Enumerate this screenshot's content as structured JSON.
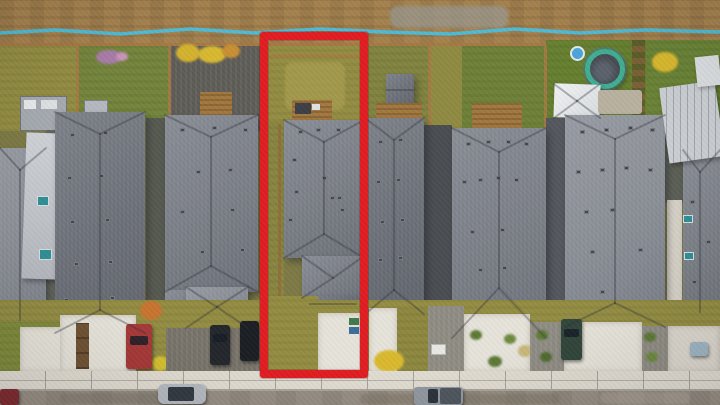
{
  "image": {
    "type": "aerial-drone-photo",
    "subject": "Top-down aerial photo of a row of narrow-lot single-family homes; one property is outlined with a red rectangle (real-estate listing highlight)",
    "width": 720,
    "height": 405,
    "visible_text": ""
  },
  "colors": {
    "highlight-red": "#e01d22",
    "dirt": "#a5824f",
    "pipe-blue": "#49bedd",
    "fence-wood": "#a97843",
    "grass-olive": "#938d43",
    "grass-olive-light": "#a89c4e",
    "grass-green": "#74853c",
    "grass-vivid": "#66802f",
    "gravel-dark": "#5d5b55",
    "gravel-light": "#8d8a82",
    "roof-main": "#797d85",
    "roof-dark": "#6b6f77",
    "roof-light": "#888c94",
    "roof-pale": "#9fa4ab",
    "roof-white": "#ccd0d4",
    "concrete": "#e6e3da",
    "sidewalk": "#e0dcd2",
    "street": "#968e84",
    "street-dark": "#7e776e",
    "deck-wood": "#a3783f",
    "stone-path": "#b3ac9c",
    "shadow-gap": "#54575d",
    "trampoline-ring": "#3fae92",
    "trampoline-mat": "#474b52",
    "pool-blue": "#4da4d8",
    "car-red": "#a63838",
    "car-darkred": "#7e2b30",
    "car-silver": "#b4bac0",
    "car-black": "#23262b",
    "car-green-suv": "#31463a",
    "truck-gray": "#9198a0",
    "skylight-teal": "#2e8f96"
  },
  "highlight": {
    "x": 260,
    "y": 32,
    "width": 108,
    "height": 346,
    "border_px": 8,
    "purpose": "outlined property for sale"
  },
  "scene": {
    "objects": [
      "dirt-alley",
      "water-supply-line",
      "back-fence",
      "backyards",
      "utility-trailer",
      "trampoline",
      "kiddie-pool",
      "gazebo-roof",
      "garden-shed",
      "wood-decks",
      "stone-path",
      "house-roofs",
      "roof-vents",
      "front-driveways",
      "xeriscape-beds",
      "parked-cars",
      "sidewalk",
      "street",
      "property-highlight-outline"
    ],
    "water_line_points": "0,33 55,30 120,34 190,29 255,33 320,29 385,32 450,34 515,29 580,33 645,30 720,32",
    "roof_vents": [
      [
        70,
        133
      ],
      [
        103,
        131
      ],
      [
        67,
        176
      ],
      [
        99,
        174
      ],
      [
        70,
        220
      ],
      [
        105,
        218
      ],
      [
        74,
        262
      ],
      [
        108,
        260
      ],
      [
        64,
        298
      ],
      [
        110,
        296
      ],
      [
        180,
        128
      ],
      [
        212,
        126
      ],
      [
        243,
        128
      ],
      [
        196,
        170
      ],
      [
        228,
        168
      ],
      [
        180,
        210
      ],
      [
        230,
        208
      ],
      [
        200,
        250
      ],
      [
        240,
        248
      ],
      [
        298,
        130
      ],
      [
        316,
        128
      ],
      [
        336,
        128
      ],
      [
        292,
        158
      ],
      [
        294,
        190
      ],
      [
        288,
        218
      ],
      [
        322,
        176
      ],
      [
        330,
        196
      ],
      [
        337,
        196
      ],
      [
        340,
        208
      ],
      [
        378,
        140
      ],
      [
        398,
        138
      ],
      [
        376,
        180
      ],
      [
        396,
        178
      ],
      [
        380,
        220
      ],
      [
        400,
        218
      ],
      [
        378,
        258
      ],
      [
        398,
        256
      ],
      [
        466,
        142
      ],
      [
        486,
        140
      ],
      [
        506,
        140
      ],
      [
        524,
        142
      ],
      [
        462,
        180
      ],
      [
        478,
        178
      ],
      [
        496,
        176
      ],
      [
        514,
        178
      ],
      [
        470,
        230
      ],
      [
        500,
        228
      ],
      [
        478,
        268
      ],
      [
        502,
        266
      ],
      [
        580,
        130
      ],
      [
        604,
        128
      ],
      [
        628,
        126
      ],
      [
        650,
        128
      ],
      [
        576,
        170
      ],
      [
        600,
        168
      ],
      [
        624,
        166
      ],
      [
        648,
        168
      ],
      [
        584,
        210
      ],
      [
        610,
        208
      ],
      [
        590,
        250
      ],
      [
        638,
        248
      ],
      [
        600,
        290
      ],
      [
        690,
        200
      ],
      [
        706,
        240
      ],
      [
        692,
        280
      ]
    ],
    "ridge_lines": [
      [
        100,
        134,
        100,
        310
      ],
      [
        55,
        112,
        100,
        134
      ],
      [
        145,
        112,
        100,
        134
      ],
      [
        55,
        333,
        100,
        310
      ],
      [
        145,
        333,
        100,
        310
      ],
      [
        211,
        137,
        211,
        266
      ],
      [
        165,
        115,
        211,
        137
      ],
      [
        258,
        115,
        211,
        137
      ],
      [
        165,
        292,
        211,
        266
      ],
      [
        258,
        292,
        211,
        266
      ],
      [
        186,
        287,
        217,
        307
      ],
      [
        248,
        287,
        217,
        307
      ],
      [
        186,
        328,
        217,
        307
      ],
      [
        248,
        328,
        217,
        307
      ],
      [
        324,
        142,
        324,
        234
      ],
      [
        284,
        120,
        324,
        142
      ],
      [
        364,
        120,
        324,
        142
      ],
      [
        284,
        258,
        324,
        234
      ],
      [
        364,
        258,
        324,
        234
      ],
      [
        302,
        256,
        333,
        278
      ],
      [
        364,
        256,
        333,
        278
      ],
      [
        302,
        298,
        333,
        278
      ],
      [
        310,
        304,
        356,
        304
      ],
      [
        394,
        140,
        394,
        290
      ],
      [
        365,
        118,
        394,
        140
      ],
      [
        424,
        118,
        394,
        140
      ],
      [
        365,
        314,
        394,
        290
      ],
      [
        424,
        314,
        394,
        290
      ],
      [
        499,
        152,
        499,
        288
      ],
      [
        452,
        128,
        499,
        152
      ],
      [
        546,
        128,
        499,
        152
      ],
      [
        452,
        338,
        499,
        288
      ],
      [
        546,
        338,
        499,
        288
      ],
      [
        615,
        139,
        615,
        303
      ],
      [
        565,
        115,
        615,
        139
      ],
      [
        665,
        115,
        615,
        139
      ],
      [
        565,
        327,
        615,
        303
      ],
      [
        665,
        327,
        615,
        303
      ],
      [
        700,
        172,
        700,
        312
      ],
      [
        683,
        150,
        700,
        172
      ],
      [
        720,
        150,
        700,
        172
      ],
      [
        20,
        170,
        20,
        320
      ],
      [
        0,
        148,
        20,
        170
      ],
      [
        46,
        148,
        20,
        170
      ],
      [
        554,
        84,
        577,
        101
      ],
      [
        600,
        84,
        577,
        101
      ],
      [
        554,
        118,
        577,
        101
      ],
      [
        600,
        118,
        577,
        101
      ],
      [
        386,
        90,
        414,
        90
      ]
    ]
  }
}
